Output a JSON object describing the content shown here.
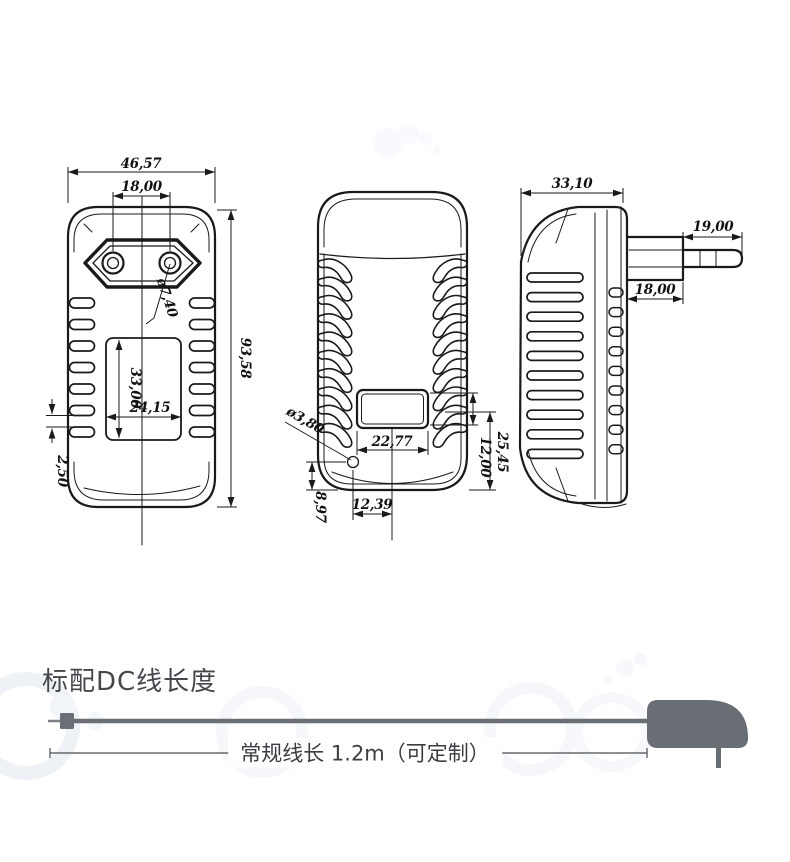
{
  "page": {
    "background": "#ffffff"
  },
  "views": {
    "front": {
      "dims": {
        "width": "46,57",
        "pin_spacing": "18,00",
        "pin_diameter": "ø7,40",
        "height": "93,58",
        "label_height": "33,00",
        "label_width": "24,15",
        "vent_gap": "2,50"
      }
    },
    "back": {
      "dims": {
        "hole_diameter": "ø3,80",
        "window_width": "22,77",
        "window_height": "12,00",
        "window_bottom_offset": "25,45",
        "hole_center_offset": "12,39",
        "hole_bottom_offset": "8,97"
      }
    },
    "side": {
      "dims": {
        "depth": "33,10",
        "pin_length": "19,00",
        "pin_base_width": "18,00"
      }
    }
  },
  "cable_section": {
    "title": "标配DC线长度",
    "length_label": "常规线长 1.2m（可定制）"
  },
  "colors": {
    "line": "#1a1a1a",
    "silhouette": "#696e75",
    "text": "#44484d"
  }
}
